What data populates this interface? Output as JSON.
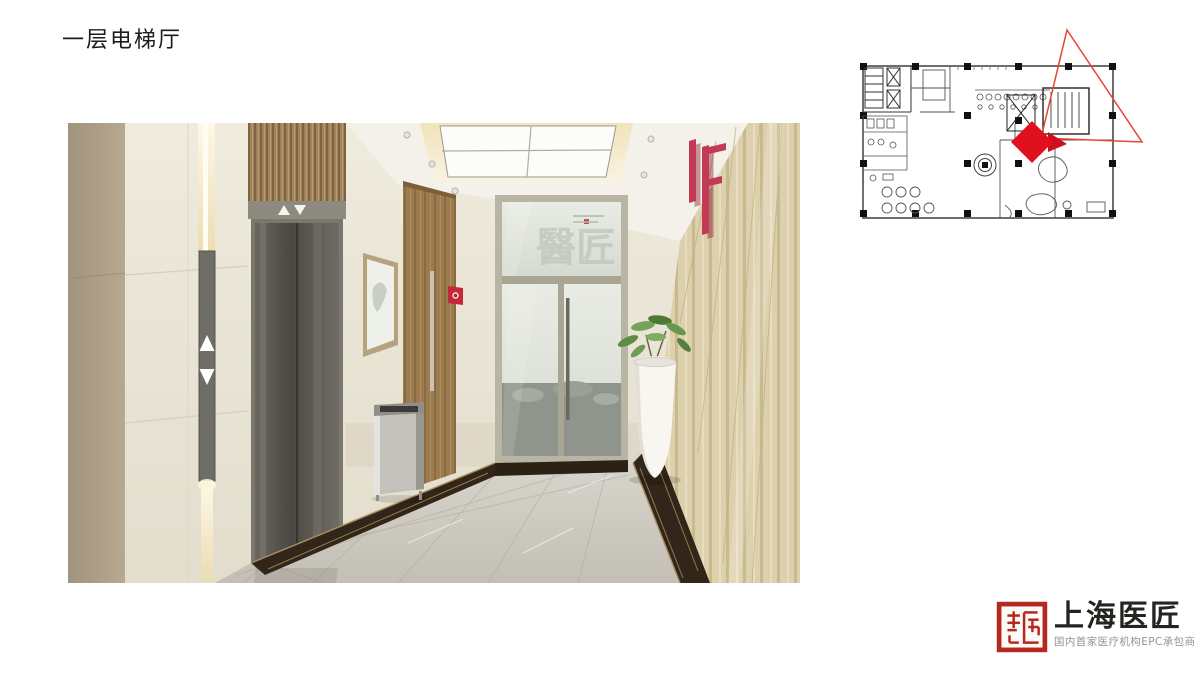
{
  "slide": {
    "title": "一层电梯厅",
    "background_color": "#ffffff"
  },
  "rendering": {
    "description": "first floor elevator hall interior rendering",
    "floor_sign": "1F",
    "glass_watermark": "醫匠",
    "elevator_indicator_up": "▲",
    "elevator_indicator_down": "▼",
    "colors": {
      "wall_cream": "#eae5d6",
      "wall_tan": "#b1a28a",
      "elevator_door": "#55534c",
      "wood_door": "#9c7b4e",
      "right_wall_wood": "#dccfab",
      "floor_marble": "#ccc8bf",
      "dark_marble_border": "#32261a",
      "sign_red": "#c23a55",
      "alarm_red": "#c5273a"
    }
  },
  "floor_plan": {
    "description": "first floor plan thumbnail with camera view marker",
    "marker_color": "#e0101e",
    "view_cone_color": "#e8442f",
    "line_color": "#4a4a4a"
  },
  "logo": {
    "company_name": "上海医匠",
    "tagline": "国内首家医疗机构EPC承包商",
    "seal_color": "#b5281e",
    "name_color": "#262421",
    "tagline_color": "#949494"
  }
}
